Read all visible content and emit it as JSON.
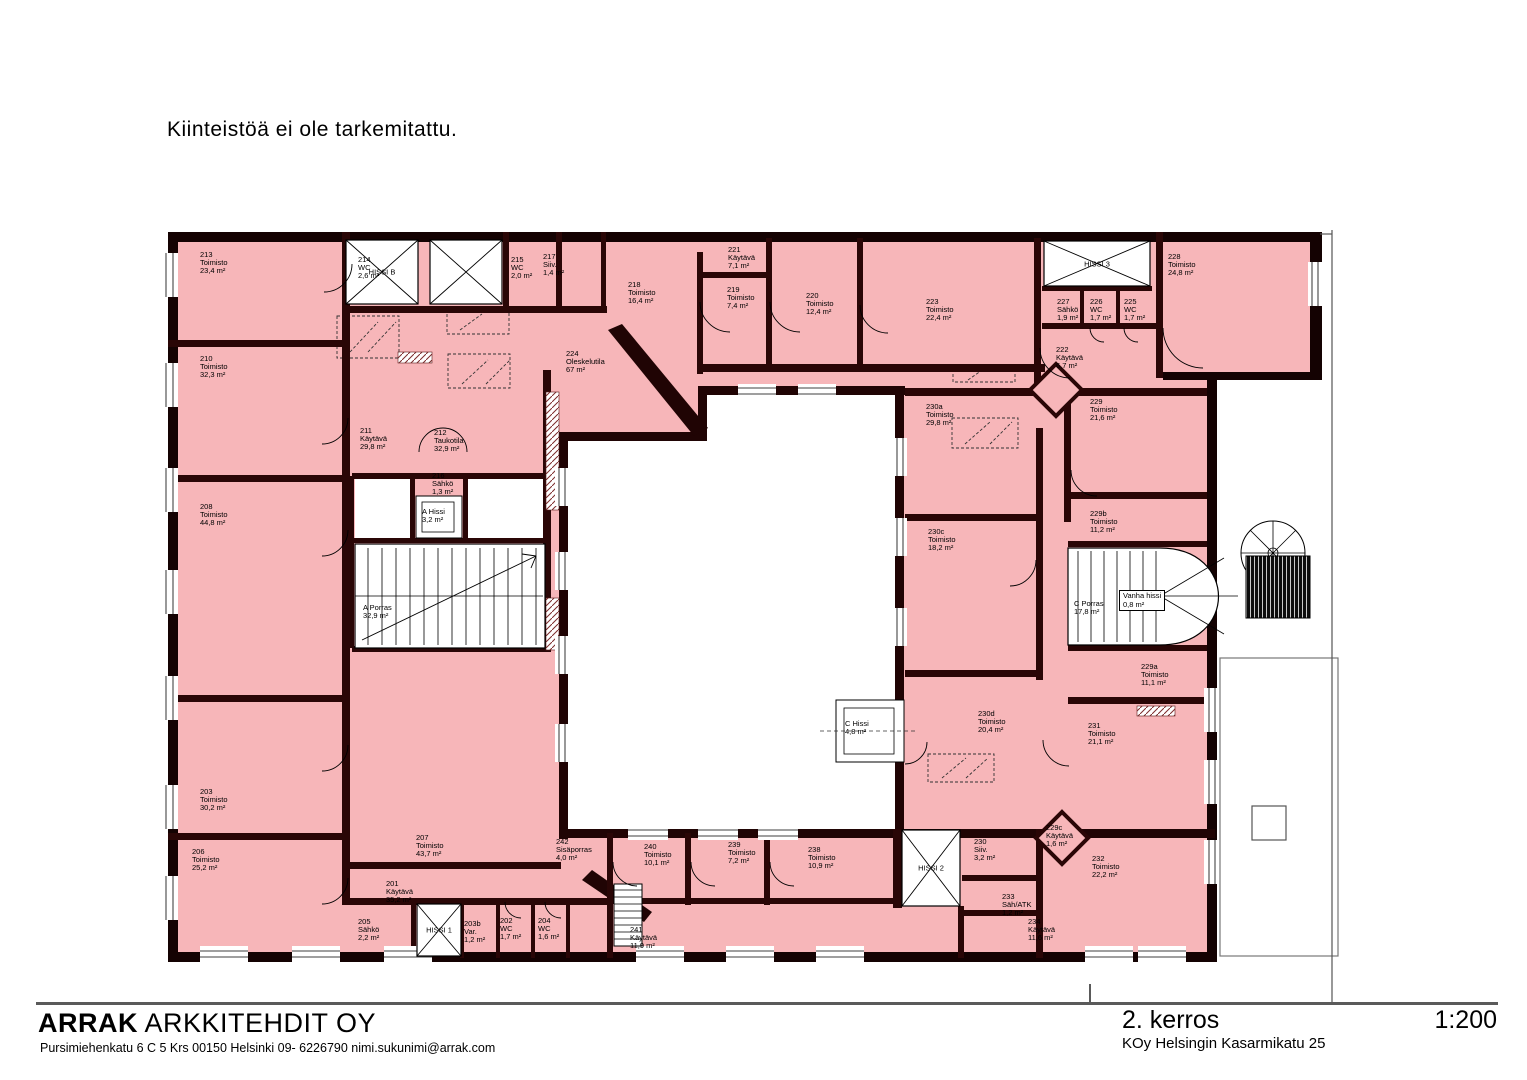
{
  "note": "Kiinteistöä ei ole tarkemitattu.",
  "footer": {
    "firm_name_bold": "ARRAK",
    "firm_name_rest": " ARKKITEHDIT OY",
    "firm_address": "Pursimiehenkatu 6 C 5 Krs  00150 Helsinki  09- 6226790  nimi.sukunimi@arrak.com",
    "floor_label": "2. kerros",
    "project_label": "KOy Helsingin Kasarmikatu 25",
    "scale_label": "1:200"
  },
  "plan": {
    "colors": {
      "room_fill": "#f7b6b9",
      "wall": "#2a0606",
      "outer_wall": "#140202",
      "line": "#000000"
    },
    "rooms": [
      {
        "n": "213",
        "t": "Toimisto",
        "a": "23,4 m²",
        "x": 200,
        "y": 251
      },
      {
        "n": "214",
        "t": "WC",
        "a": "2,6 m²",
        "x": 358,
        "y": 256
      },
      {
        "n": "215",
        "t": "WC",
        "a": "2,0 m²",
        "x": 511,
        "y": 256
      },
      {
        "n": "217",
        "t": "Siiv.",
        "a": "1,4 m²",
        "x": 543,
        "y": 253
      },
      {
        "n": "218",
        "t": "Toimisto",
        "a": "16,4 m²",
        "x": 628,
        "y": 281
      },
      {
        "n": "221",
        "t": "Käytävä",
        "a": "7,1 m²",
        "x": 728,
        "y": 246
      },
      {
        "n": "219",
        "t": "Toimisto",
        "a": "7,4 m²",
        "x": 727,
        "y": 286
      },
      {
        "n": "220",
        "t": "Toimisto",
        "a": "12,4 m²",
        "x": 806,
        "y": 292
      },
      {
        "n": "223",
        "t": "Toimisto",
        "a": "22,4 m²",
        "x": 926,
        "y": 298
      },
      {
        "n": "227",
        "t": "Sähkö",
        "a": "1,9 m²",
        "x": 1057,
        "y": 298
      },
      {
        "n": "226",
        "t": "WC",
        "a": "1,7 m²",
        "x": 1090,
        "y": 298
      },
      {
        "n": "225",
        "t": "WC",
        "a": "1,7 m²",
        "x": 1124,
        "y": 298
      },
      {
        "n": "228",
        "t": "Toimisto",
        "a": "24,8 m²",
        "x": 1168,
        "y": 253
      },
      {
        "n": "222",
        "t": "Käytävä",
        "a": "6,7 m²",
        "x": 1056,
        "y": 346
      },
      {
        "n": "224",
        "t": "Oleskelutila",
        "a": "67 m²",
        "x": 566,
        "y": 350
      },
      {
        "n": "210",
        "t": "Toimisto",
        "a": "32,3 m²",
        "x": 200,
        "y": 355
      },
      {
        "n": "211",
        "t": "Käytävä",
        "a": "29,8 m²",
        "x": 360,
        "y": 427
      },
      {
        "n": "212",
        "t": "Taukotila",
        "a": "32,9 m²",
        "x": 434,
        "y": 429
      },
      {
        "n": "216",
        "t": "Sähkö",
        "a": "1,3 m²",
        "x": 432,
        "y": 472
      },
      {
        "n": "A Hissi",
        "t": "3,2 m²",
        "a": "",
        "x": 422,
        "y": 508
      },
      {
        "n": "A Porras",
        "t": "32,9 m²",
        "a": "",
        "x": 363,
        "y": 604
      },
      {
        "n": "208",
        "t": "Toimisto",
        "a": "44,8 m²",
        "x": 200,
        "y": 503
      },
      {
        "n": "203",
        "t": "Toimisto",
        "a": "30,2 m²",
        "x": 200,
        "y": 788
      },
      {
        "n": "206",
        "t": "Toimisto",
        "a": "25,2 m²",
        "x": 192,
        "y": 848
      },
      {
        "n": "230a",
        "t": "Toimisto",
        "a": "29,8 m²",
        "x": 926,
        "y": 403
      },
      {
        "n": "229",
        "t": "Toimisto",
        "a": "21,6 m²",
        "x": 1090,
        "y": 398
      },
      {
        "n": "230c",
        "t": "Toimisto",
        "a": "18,2 m²",
        "x": 928,
        "y": 528
      },
      {
        "n": "229b",
        "t": "Toimisto",
        "a": "11,2 m²",
        "x": 1090,
        "y": 510
      },
      {
        "n": "C Porras",
        "t": "17,8 m²",
        "a": "",
        "x": 1074,
        "y": 600
      },
      {
        "n": "Vanha hissi",
        "t": "0,8 m²",
        "a": "",
        "x": 1119,
        "y": 590,
        "boxed": true
      },
      {
        "n": "229a",
        "t": "Toimisto",
        "a": "11,1 m²",
        "x": 1141,
        "y": 663
      },
      {
        "n": "230d",
        "t": "Toimisto",
        "a": "20,4 m²",
        "x": 978,
        "y": 710
      },
      {
        "n": "231",
        "t": "Toimisto",
        "a": "21,1 m²",
        "x": 1088,
        "y": 722
      },
      {
        "n": "C Hissi",
        "t": "4,8 m²",
        "a": "",
        "x": 845,
        "y": 720
      },
      {
        "n": "229c",
        "t": "Käytävä",
        "a": "1,6 m²",
        "x": 1046,
        "y": 824
      },
      {
        "n": "230",
        "t": "Siiv.",
        "a": "3,2 m²",
        "x": 974,
        "y": 838
      },
      {
        "n": "232",
        "t": "Toimisto",
        "a": "22,2 m²",
        "x": 1092,
        "y": 855
      },
      {
        "n": "233",
        "t": "Säh/ATK",
        "a": "1,2 m²",
        "x": 1002,
        "y": 893
      },
      {
        "n": "234",
        "t": "Käytävä",
        "a": "11,6 m²",
        "x": 1028,
        "y": 918
      },
      {
        "n": "242",
        "t": "Sisäporras",
        "a": "4,0 m²",
        "x": 556,
        "y": 838
      },
      {
        "n": "240",
        "t": "Toimisto",
        "a": "10,1 m²",
        "x": 644,
        "y": 843
      },
      {
        "n": "239",
        "t": "Toimisto",
        "a": "7,2 m²",
        "x": 728,
        "y": 841
      },
      {
        "n": "238",
        "t": "Toimisto",
        "a": "10,9 m²",
        "x": 808,
        "y": 846
      },
      {
        "n": "241",
        "t": "Käytävä",
        "a": "11,9 m²",
        "x": 630,
        "y": 926
      },
      {
        "n": "207",
        "t": "Toimisto",
        "a": "43,7 m²",
        "x": 416,
        "y": 834
      },
      {
        "n": "201",
        "t": "Käytävä",
        "a": "35,2 m²",
        "x": 386,
        "y": 880
      },
      {
        "n": "205",
        "t": "Sähkö",
        "a": "2,2 m²",
        "x": 358,
        "y": 918
      },
      {
        "n": "203b",
        "t": "Var.",
        "a": "1,2 m²",
        "x": 464,
        "y": 920
      },
      {
        "n": "202",
        "t": "WC",
        "a": "1,7 m²",
        "x": 500,
        "y": 917
      },
      {
        "n": "204",
        "t": "WC",
        "a": "1,6 m²",
        "x": 538,
        "y": 917
      }
    ],
    "elevators": [
      {
        "label": "HISSI B",
        "x": 382,
        "y": 272
      },
      {
        "label": "HISSI 3",
        "x": 1097,
        "y": 264
      },
      {
        "label": "HISSI 2",
        "x": 931,
        "y": 868
      },
      {
        "label": "HISSI 1",
        "x": 439,
        "y": 930
      }
    ]
  }
}
